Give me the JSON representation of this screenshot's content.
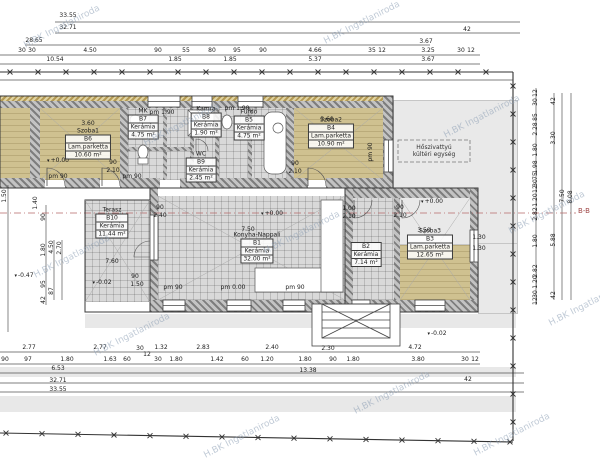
{
  "watermark_text": "H.BK Ingatlaniroda",
  "section_label": "B-B",
  "outdoor_unit": {
    "line1": "Hőszivattyú",
    "line2": "kültéri egység"
  },
  "rooms": [
    {
      "name": "Szoba1",
      "code": "B6",
      "floor": "Lam.parketta",
      "area": "10.60 m²",
      "x": 88,
      "y": 144
    },
    {
      "name": "MK",
      "code": "B7",
      "floor": "Kerámia",
      "area": "4.75 m²",
      "x": 143,
      "y": 124
    },
    {
      "name": "Kamra",
      "code": "B8",
      "floor": "Kerámia",
      "area": "1.90 m²",
      "x": 206,
      "y": 122
    },
    {
      "name": "Fürdő",
      "code": "B5",
      "floor": "Kerámia",
      "area": "4.75 m²",
      "x": 249,
      "y": 125
    },
    {
      "name": "WC",
      "code": "B9",
      "floor": "Kerámia",
      "area": "2.45 m²",
      "x": 201,
      "y": 167
    },
    {
      "name": "Szoba2",
      "code": "B4",
      "floor": "Lam.parketta",
      "area": "10.90 m²",
      "x": 331,
      "y": 133
    },
    {
      "name": "Konyha-Nappali",
      "code": "B1",
      "floor": "Kerámia",
      "area": "32.00 m²",
      "x": 257,
      "y": 248
    },
    {
      "name": "Terasz",
      "code": "B10",
      "floor": "Kerámia",
      "area": "11.44 m²",
      "x": 112,
      "y": 223
    },
    {
      "name": "",
      "code": "B2",
      "floor": "Kerámia",
      "area": "7.14 m²",
      "x": 366,
      "y": 255
    },
    {
      "name": "Szoba3",
      "code": "B3",
      "floor": "Lam.parketta",
      "area": "12.65 m²",
      "x": 430,
      "y": 244
    }
  ],
  "levels": [
    {
      "value": "+0.00",
      "x": 58,
      "y": 161
    },
    {
      "value": "+0.00",
      "x": 272,
      "y": 214
    },
    {
      "value": "+0.00",
      "x": 432,
      "y": 202
    },
    {
      "value": "-0.02",
      "x": 102,
      "y": 283
    },
    {
      "value": "-0.47",
      "x": 24,
      "y": 276
    },
    {
      "value": "-0.02",
      "x": 437,
      "y": 334
    }
  ],
  "dimensions": [
    {
      "t": "33.55",
      "x": 68,
      "y": 16
    },
    {
      "t": "32.71",
      "x": 68,
      "y": 28
    },
    {
      "t": "28.65",
      "x": 34,
      "y": 41
    },
    {
      "t": "3.67",
      "x": 426,
      "y": 42
    },
    {
      "t": "42",
      "x": 467,
      "y": 30
    },
    {
      "t": "30",
      "x": 22,
      "y": 51
    },
    {
      "t": "30",
      "x": 32,
      "y": 51
    },
    {
      "t": "4.50",
      "x": 90,
      "y": 51
    },
    {
      "t": "90",
      "x": 158,
      "y": 51
    },
    {
      "t": "55",
      "x": 186,
      "y": 51
    },
    {
      "t": "80",
      "x": 212,
      "y": 51
    },
    {
      "t": "95",
      "x": 237,
      "y": 51
    },
    {
      "t": "90",
      "x": 263,
      "y": 51
    },
    {
      "t": "4.66",
      "x": 315,
      "y": 51
    },
    {
      "t": "35",
      "x": 372,
      "y": 51
    },
    {
      "t": "12",
      "x": 382,
      "y": 51
    },
    {
      "t": "3.25",
      "x": 428,
      "y": 51
    },
    {
      "t": "30",
      "x": 461,
      "y": 51
    },
    {
      "t": "12",
      "x": 471,
      "y": 51
    },
    {
      "t": "10.54",
      "x": 55,
      "y": 60
    },
    {
      "t": "1.85",
      "x": 175,
      "y": 60
    },
    {
      "t": "1.85",
      "x": 230,
      "y": 60
    },
    {
      "t": "5.37",
      "x": 315,
      "y": 60
    },
    {
      "t": "3.67",
      "x": 428,
      "y": 60
    },
    {
      "t": "2.77",
      "x": 29,
      "y": 348
    },
    {
      "t": "2.77",
      "x": 100,
      "y": 348
    },
    {
      "t": "30",
      "x": 140,
      "y": 349
    },
    {
      "t": "1.32",
      "x": 161,
      "y": 348
    },
    {
      "t": "2.83",
      "x": 203,
      "y": 348
    },
    {
      "t": "2.40",
      "x": 272,
      "y": 348
    },
    {
      "t": "2.30",
      "x": 328,
      "y": 349
    },
    {
      "t": "4.72",
      "x": 415,
      "y": 348
    },
    {
      "t": "90",
      "x": 5,
      "y": 360
    },
    {
      "t": "97",
      "x": 28,
      "y": 360
    },
    {
      "t": "1.80",
      "x": 67,
      "y": 360
    },
    {
      "t": "1.63",
      "x": 110,
      "y": 360
    },
    {
      "t": "60",
      "x": 127,
      "y": 360
    },
    {
      "t": "12",
      "x": 147,
      "y": 355
    },
    {
      "t": "30",
      "x": 158,
      "y": 360
    },
    {
      "t": "1.80",
      "x": 176,
      "y": 360
    },
    {
      "t": "1.42",
      "x": 217,
      "y": 360
    },
    {
      "t": "60",
      "x": 245,
      "y": 360
    },
    {
      "t": "1.20",
      "x": 267,
      "y": 360
    },
    {
      "t": "1.80",
      "x": 305,
      "y": 360
    },
    {
      "t": "90",
      "x": 333,
      "y": 360
    },
    {
      "t": "1.80",
      "x": 353,
      "y": 360
    },
    {
      "t": "3.80",
      "x": 418,
      "y": 360
    },
    {
      "t": "30",
      "x": 465,
      "y": 360
    },
    {
      "t": "12",
      "x": 475,
      "y": 360
    },
    {
      "t": "6.53",
      "x": 58,
      "y": 369
    },
    {
      "t": "13.38",
      "x": 308,
      "y": 371
    },
    {
      "t": "32.71",
      "x": 58,
      "y": 381
    },
    {
      "t": "42",
      "x": 468,
      "y": 380
    },
    {
      "t": "33.55",
      "x": 58,
      "y": 390
    },
    {
      "t": "12",
      "x": 536,
      "y": 93,
      "r": 1
    },
    {
      "t": "30",
      "x": 536,
      "y": 102,
      "r": 1
    },
    {
      "t": "85",
      "x": 536,
      "y": 117,
      "r": 1
    },
    {
      "t": "2.28",
      "x": 536,
      "y": 129,
      "r": 1
    },
    {
      "t": "1.80",
      "x": 536,
      "y": 150,
      "r": 1
    },
    {
      "t": "1.98",
      "x": 536,
      "y": 167,
      "r": 1
    },
    {
      "t": "75",
      "x": 536,
      "y": 176,
      "r": 1
    },
    {
      "t": "30",
      "x": 536,
      "y": 183,
      "r": 1
    },
    {
      "t": "12",
      "x": 536,
      "y": 189,
      "r": 1
    },
    {
      "t": "1.20",
      "x": 536,
      "y": 200,
      "r": 1
    },
    {
      "t": "2.82",
      "x": 536,
      "y": 214,
      "r": 1
    },
    {
      "t": "1.80",
      "x": 536,
      "y": 241,
      "r": 1
    },
    {
      "t": "2.82",
      "x": 536,
      "y": 271,
      "r": 1
    },
    {
      "t": "1.20",
      "x": 536,
      "y": 282,
      "r": 1
    },
    {
      "t": "30",
      "x": 536,
      "y": 294,
      "r": 1
    },
    {
      "t": "12",
      "x": 536,
      "y": 301,
      "r": 1
    },
    {
      "t": "42",
      "x": 554,
      "y": 101,
      "r": 1
    },
    {
      "t": "3.30",
      "x": 554,
      "y": 138,
      "r": 1
    },
    {
      "t": "5.88",
      "x": 554,
      "y": 240,
      "r": 1
    },
    {
      "t": "42",
      "x": 554,
      "y": 295,
      "r": 1
    },
    {
      "t": "7.50",
      "x": 563,
      "y": 196,
      "r": 1
    },
    {
      "t": "8.08",
      "x": 571,
      "y": 197,
      "r": 1
    },
    {
      "t": "1.50",
      "x": 5,
      "y": 196,
      "r": 1
    },
    {
      "t": "1.40",
      "x": 36,
      "y": 203,
      "r": 1
    },
    {
      "t": "90",
      "x": 44,
      "y": 217,
      "r": 1
    },
    {
      "t": "1.80",
      "x": 44,
      "y": 250,
      "r": 1
    },
    {
      "t": "95",
      "x": 44,
      "y": 284,
      "r": 1
    },
    {
      "t": "42",
      "x": 44,
      "y": 300,
      "r": 1
    },
    {
      "t": "4.50",
      "x": 52,
      "y": 247,
      "r": 1
    },
    {
      "t": "87",
      "x": 52,
      "y": 291,
      "r": 1
    },
    {
      "t": "2.70",
      "x": 60,
      "y": 248,
      "r": 1
    },
    {
      "t": "3.60",
      "x": 88,
      "y": 124
    },
    {
      "t": "3.60",
      "x": 327,
      "y": 120
    },
    {
      "t": "3.50",
      "x": 424,
      "y": 231
    },
    {
      "t": "7.50",
      "x": 248,
      "y": 230
    },
    {
      "t": "7.60",
      "x": 112,
      "y": 262
    },
    {
      "t": "90",
      "x": 113,
      "y": 163
    },
    {
      "t": "2.10",
      "x": 113,
      "y": 171
    },
    {
      "t": "90",
      "x": 160,
      "y": 208
    },
    {
      "t": "2.40",
      "x": 160,
      "y": 216
    },
    {
      "t": "90",
      "x": 295,
      "y": 164
    },
    {
      "t": "2.10",
      "x": 295,
      "y": 172
    },
    {
      "t": "1.00",
      "x": 349,
      "y": 209
    },
    {
      "t": "2.10",
      "x": 349,
      "y": 217
    },
    {
      "t": "90",
      "x": 400,
      "y": 208
    },
    {
      "t": "2.10",
      "x": 400,
      "y": 216
    },
    {
      "t": "90",
      "x": 135,
      "y": 277
    },
    {
      "t": "1.50",
      "x": 137,
      "y": 285
    },
    {
      "t": "1.30",
      "x": 479,
      "y": 238
    },
    {
      "t": "1.30",
      "x": 479,
      "y": 249
    },
    {
      "t": "pm 90",
      "x": 58,
      "y": 177
    },
    {
      "t": "pm 90",
      "x": 132,
      "y": 177
    },
    {
      "t": "pm 1.90",
      "x": 162,
      "y": 113
    },
    {
      "t": "pm 1.90",
      "x": 237,
      "y": 109
    },
    {
      "t": "pm 90",
      "x": 371,
      "y": 152,
      "r": 1
    },
    {
      "t": "pm 90",
      "x": 173,
      "y": 288
    },
    {
      "t": "pm 0.00",
      "x": 233,
      "y": 288
    },
    {
      "t": "pm 90",
      "x": 295,
      "y": 288
    }
  ]
}
